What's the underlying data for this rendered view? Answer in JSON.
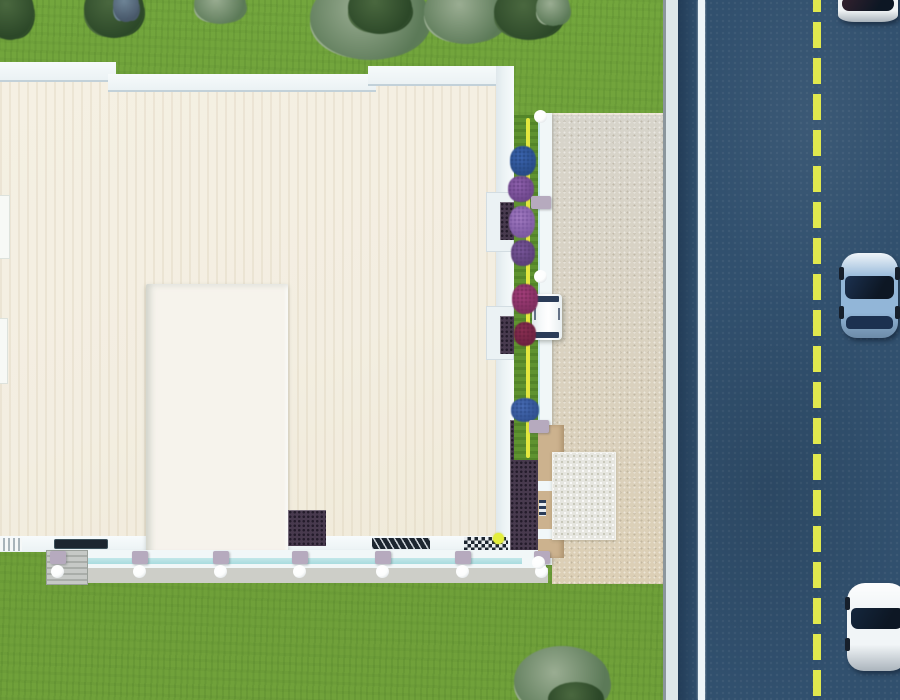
{
  "scene": {
    "type": "aerial-3d-architectural-render",
    "viewport": {
      "width": 900,
      "height": 700
    },
    "colors": {
      "grass1": "#6fa039",
      "roof": "#f3eee1",
      "parapet": "#ebf2f4",
      "parapetEdge": "#c2d1d9",
      "tower": "#f6f3ec",
      "road": "#31506e",
      "roadDark": "#223c57",
      "curb": "#dde7ea",
      "curbLine": "#8b969c",
      "roadWhite": "#edf4f8",
      "dashY": "#e0e84e",
      "courtTop": "#d7d4cb",
      "courtBot": "#dccfb5",
      "sidewalk": "#cdcec8",
      "fence": "#f1f7f8",
      "cyan": "#c2e7e9",
      "perg": "#483a4e",
      "pergDot": "#241b2b",
      "tan": "#ccb28e",
      "navy": "#2b3c58",
      "patio": "#e6e6e0",
      "patioDot": "#c7c7b9",
      "planter": "#5f9330",
      "yline": "#e3e73e",
      "postCap": "#b6aabe",
      "ball": "#fcfdfd",
      "dark1": "#1d2630",
      "van": "#f6f9fa"
    },
    "tree_variants": {
      "olive": [
        "#9aad92",
        "#5c7a58"
      ],
      "dark": [
        "#4a683f",
        "#2c4828"
      ],
      "blue": [
        "#6e8496",
        "#49596b"
      ]
    },
    "trees": [
      {
        "x": -14,
        "y": -18,
        "w": 48,
        "h": 58,
        "variant": "dark"
      },
      {
        "x": 84,
        "y": -20,
        "w": 60,
        "h": 58,
        "variant": "dark"
      },
      {
        "x": 113,
        "y": -12,
        "w": 26,
        "h": 34,
        "variant": "blue"
      },
      {
        "x": 194,
        "y": -16,
        "w": 52,
        "h": 40,
        "variant": "olive"
      },
      {
        "x": 310,
        "y": -24,
        "w": 120,
        "h": 84,
        "variant": "olive"
      },
      {
        "x": 348,
        "y": -18,
        "w": 64,
        "h": 52,
        "variant": "dark"
      },
      {
        "x": 424,
        "y": -20,
        "w": 84,
        "h": 64,
        "variant": "olive"
      },
      {
        "x": 494,
        "y": -16,
        "w": 70,
        "h": 56,
        "variant": "dark"
      },
      {
        "x": 536,
        "y": -10,
        "w": 34,
        "h": 36,
        "variant": "olive"
      },
      {
        "x": 514,
        "y": 646,
        "w": 96,
        "h": 70,
        "variant": "olive"
      },
      {
        "x": 548,
        "y": 682,
        "w": 56,
        "h": 34,
        "variant": "dark"
      }
    ],
    "flowers": [
      {
        "x": 510,
        "y": 146,
        "w": 26,
        "h": 30,
        "c1": "#3e68b4",
        "c2": "#274a85"
      },
      {
        "x": 508,
        "y": 176,
        "w": 26,
        "h": 26,
        "c1": "#9465b2",
        "c2": "#6a4488"
      },
      {
        "x": 509,
        "y": 206,
        "w": 26,
        "h": 32,
        "c1": "#a77fc6",
        "c2": "#7b58a0"
      },
      {
        "x": 511,
        "y": 240,
        "w": 24,
        "h": 26,
        "c1": "#7e5aa0",
        "c2": "#5b3f78"
      },
      {
        "x": 512,
        "y": 284,
        "w": 26,
        "h": 30,
        "c1": "#a8417e",
        "c2": "#7c2c5c"
      },
      {
        "x": 514,
        "y": 322,
        "w": 22,
        "h": 24,
        "c1": "#8e3054",
        "c2": "#6b2140"
      },
      {
        "x": 511,
        "y": 398,
        "w": 28,
        "h": 24,
        "c1": "#4a6fb8",
        "c2": "#2f4f8e"
      }
    ],
    "walkway_posts": {
      "cap_y": 551,
      "ball_y": 565,
      "x_centers": [
        58,
        140,
        221,
        300,
        383,
        463,
        542
      ]
    },
    "fence_posts": [
      {
        "x": 534,
        "y": 110,
        "type": "ball"
      },
      {
        "x": 531,
        "y": 196,
        "type": "cap"
      },
      {
        "x": 534,
        "y": 270,
        "type": "ball"
      },
      {
        "x": 529,
        "y": 420,
        "type": "cap"
      },
      {
        "x": 532,
        "y": 556,
        "type": "ball"
      }
    ],
    "road_markings": {
      "curb_x": 663,
      "white_edge_line_x": 698,
      "center_dash_x": 813,
      "dash_length": 26,
      "dash_gap": 10
    },
    "cars": [
      {
        "name": "car-white-top",
        "x": 838,
        "y": -16,
        "w": 60,
        "h": 38,
        "body": "#eff3f5",
        "glass": "#33212e",
        "gy": 14,
        "gh": 13,
        "ry": -1,
        "rh": 0,
        "wheels": false
      },
      {
        "name": "car-blue",
        "x": 841,
        "y": 253,
        "w": 57,
        "h": 85,
        "body": "#92b6d8",
        "glass": "#1c3150",
        "gy": 23,
        "gh": 23,
        "ry": 63,
        "rh": 13,
        "wheels": true
      },
      {
        "name": "car-white-bottom",
        "x": 847,
        "y": 583,
        "w": 60,
        "h": 88,
        "body": "#f1f5f7",
        "glass": "#15273d",
        "gy": 25,
        "gh": 21,
        "ry": -1,
        "rh": 0,
        "wheels": true
      }
    ]
  }
}
